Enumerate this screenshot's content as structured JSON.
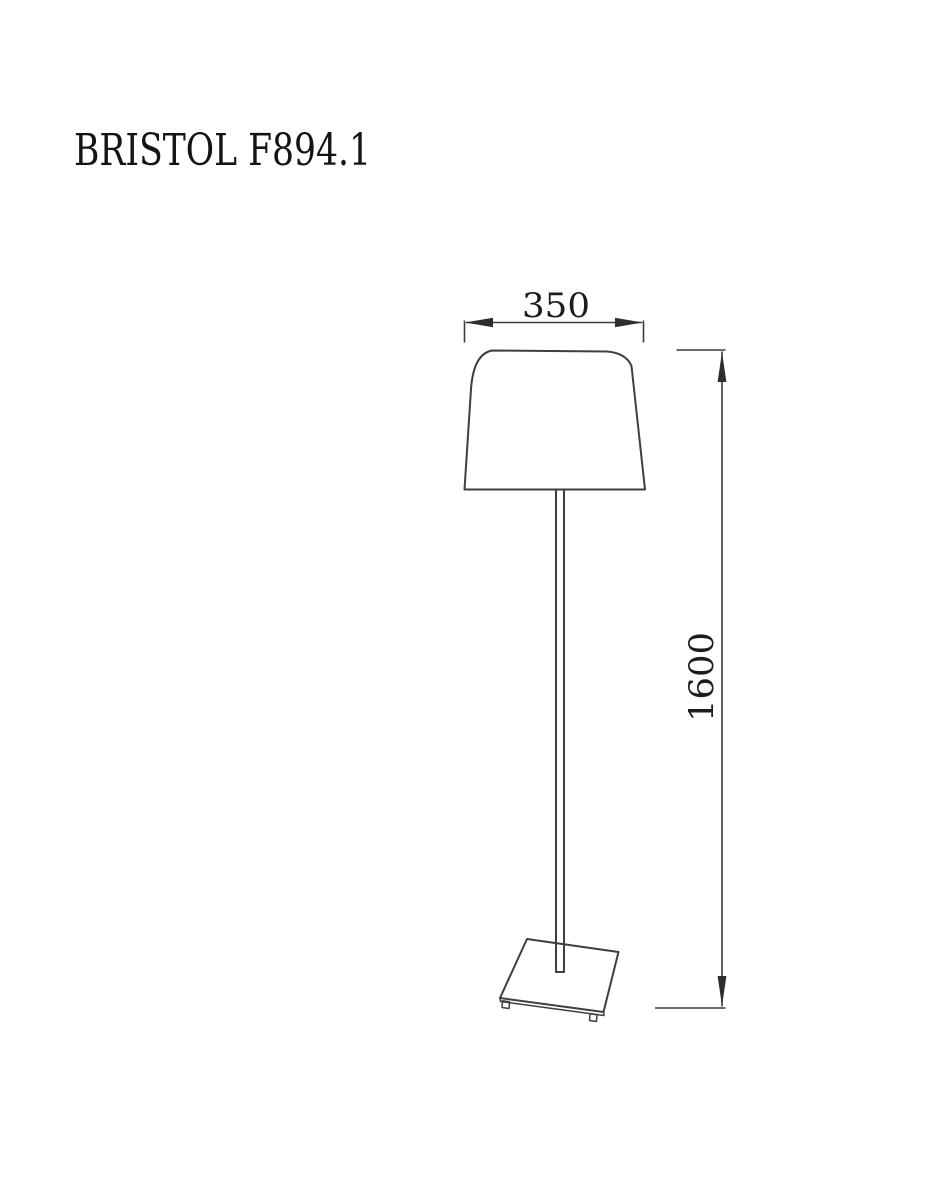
{
  "title": "BRISTOL F894.1",
  "dimensions": {
    "shade_width": "350",
    "overall_height": "1600"
  },
  "colors": {
    "background": "#ffffff",
    "line": "#3f3f3f",
    "text": "#1c1c1c"
  }
}
